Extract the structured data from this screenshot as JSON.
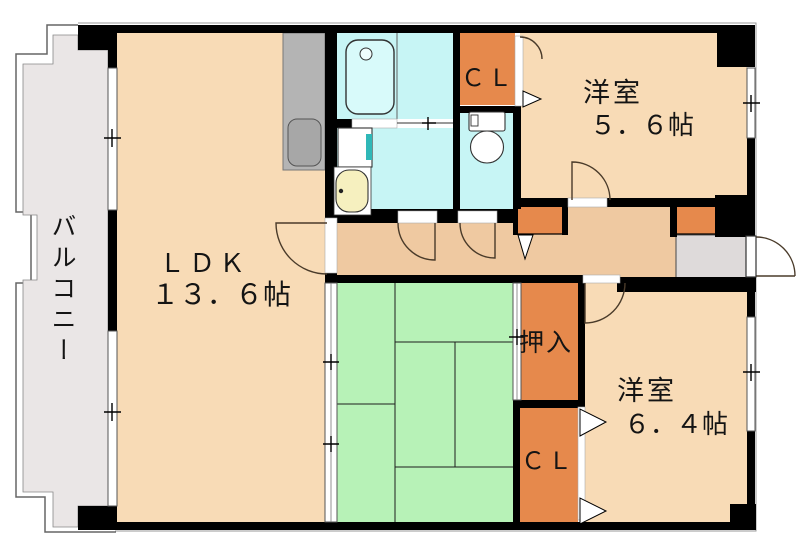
{
  "balcony": {
    "label": "バルコニー"
  },
  "rooms": {
    "ldk": {
      "name": "ＬＤＫ",
      "size": "１３．６帖"
    },
    "western_room_1": {
      "name": "洋室",
      "size": "５．６帖"
    },
    "western_room_2": {
      "name": "洋室",
      "size": "６．４帖"
    },
    "closet_upper": {
      "label": "ＣＬ"
    },
    "closet_lower": {
      "label": "ＣＬ"
    },
    "oshiire": {
      "label": "押入"
    }
  },
  "colors": {
    "room_floor": "#f8dbb6",
    "hallway_floor": "#efc9a1",
    "tatami": "#b7f2b7",
    "wet_area": "#c7f5f5",
    "closet": "#e6894c",
    "balcony": "#eae6e6",
    "entrance": "#dedada",
    "wall": "#000000",
    "kitchen_counter": "#b4b4b4"
  }
}
